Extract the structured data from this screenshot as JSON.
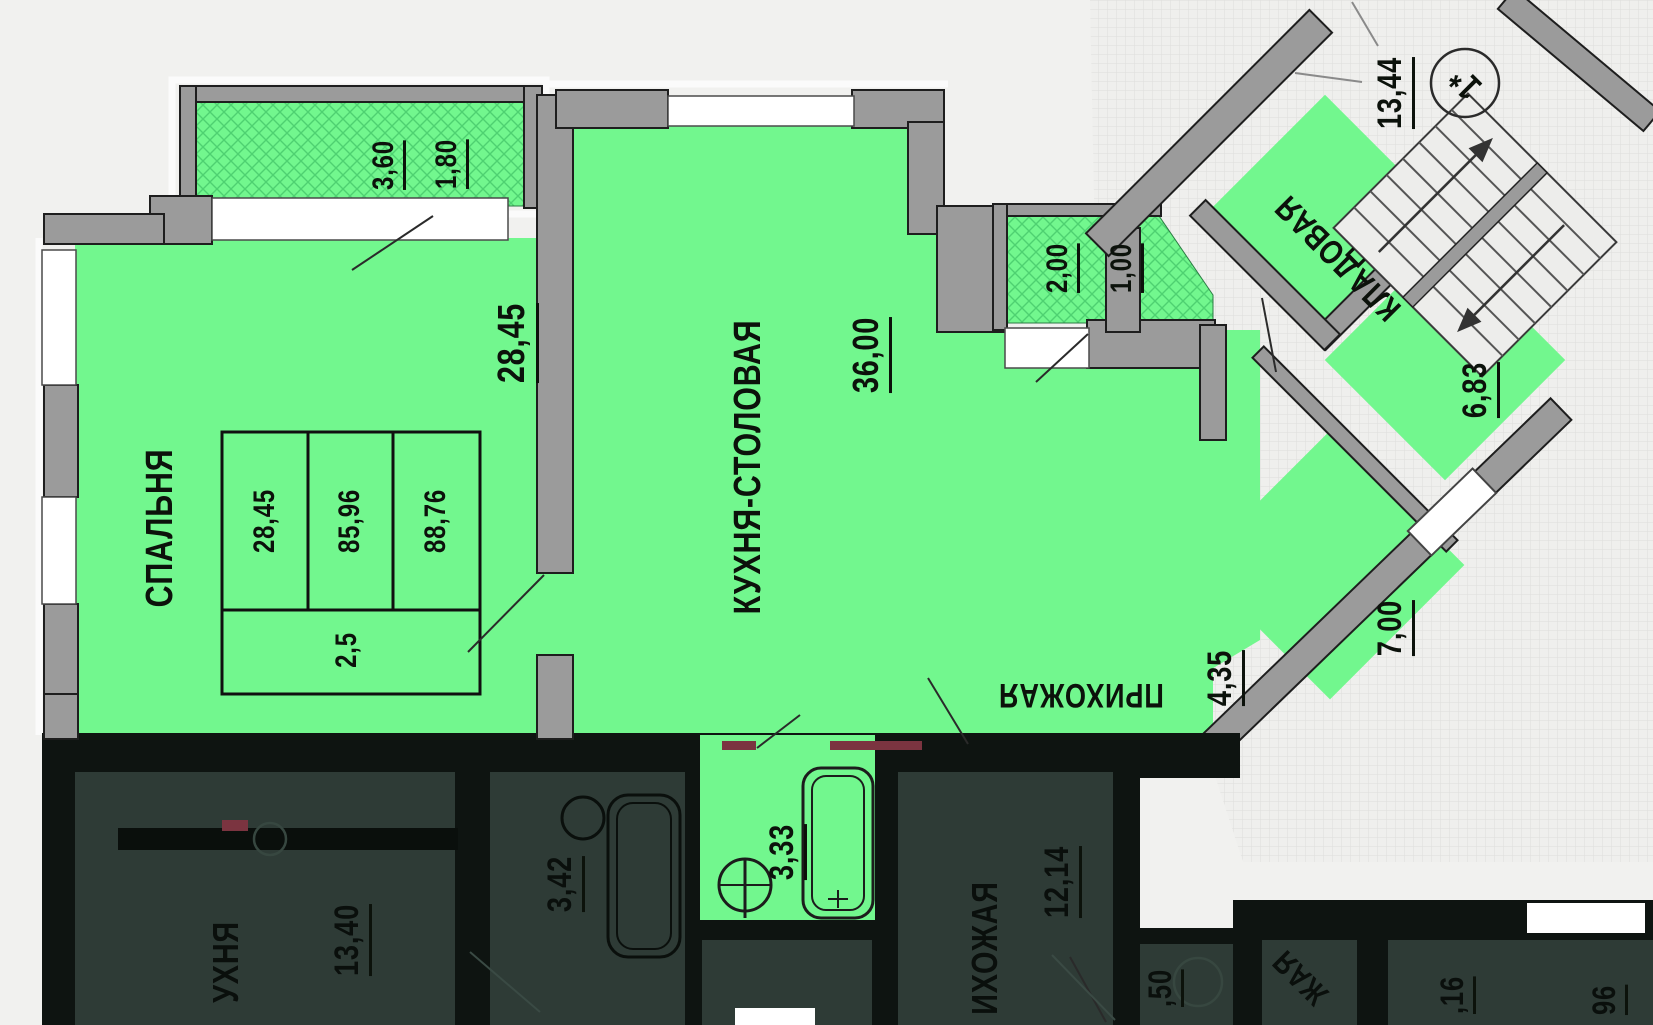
{
  "plan_type": "apartment-floor-plan",
  "colors": {
    "highlight_green": "#72f78e",
    "hatch_green": "#4ed171",
    "dim_room_bg": "#2e3b36",
    "dim_wall": "#0e1411",
    "wall_gray": "#9b9b9b",
    "window_white": "#ffffff",
    "accent_red": "#7b3440",
    "background": "#f1f1ef"
  },
  "labels": {
    "bedroom_name": "СПАЛЬНЯ",
    "bedroom_area": "28,45",
    "kitchen_name": "КУХНЯ-СТОЛОВАЯ",
    "kitchen_area": "36,00",
    "storage_name": "КЛАДОВАЯ",
    "storage_area": "6,83",
    "hall_name": "ПРИХОЖАЯ",
    "hall_area": "4,35",
    "hall2_area": "7,00",
    "bath_area": "3,33",
    "stair_dim": "13,44",
    "unit_number": "1*",
    "balcony1_top": "3,60",
    "balcony1_bottom": "1,80",
    "balcony2_top": "2,00",
    "balcony2_bottom": "1,00",
    "stamp_cell1": "28,45",
    "stamp_cell2": "85,96",
    "stamp_cell3": "88,76",
    "stamp_bottom": "2,5",
    "dark_kitchen_name": "УХНЯ",
    "dark_kitchen_area": "13,40",
    "dark_bath_area": "3,42",
    "dark_hall_name": "ИХОЖАЯ",
    "dark_hall_area": "12,14",
    "dark_corridor_area": ",50",
    "dark_partial_word": "ЖАЯ",
    "dark_partial_num1": ",16",
    "dark_partial_num2": "96"
  }
}
